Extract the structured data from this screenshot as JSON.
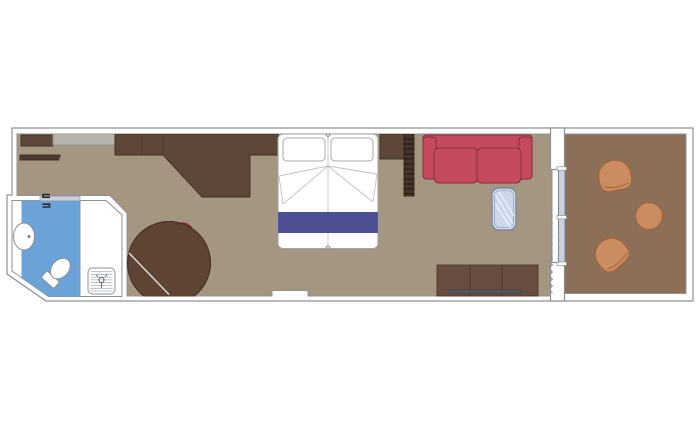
{
  "document": {
    "type": "floor-plan",
    "subject": "cruise-ship-cabin-with-balcony"
  },
  "rooms": [
    {
      "name": "cabin"
    },
    {
      "name": "bathroom"
    },
    {
      "name": "balcony"
    }
  ],
  "furniture": [
    "entry-door",
    "entry-closet",
    "luggage-shelf",
    "wardrobe-desk-unit",
    "washbasin",
    "toilet",
    "shower",
    "shower-drain",
    "bathroom-sliding-door",
    "round-dining-table",
    "red-tub-chair",
    "double-bed",
    "pillows",
    "bed-runner",
    "pullman-ladder",
    "red-sofa",
    "glass-coffee-table",
    "tv-dresser",
    "balcony-sliding-door",
    "curtain",
    "balcony-chair-top",
    "balcony-chair-bottom",
    "balcony-round-table"
  ],
  "colors": {
    "background": "#ffffff",
    "wall_fill": "#ffffff",
    "wall_stroke": "#8f9191",
    "cabin_floor": "#a49681",
    "balcony_floor": "#8b6f57",
    "dark_wood": "#5c4738",
    "dresser_wood": "#684e41",
    "table_wood": "#5e4434",
    "shelf_grey": "#b8b4ac",
    "door_leaf": "#4e3b30",
    "ladder": "#463529",
    "bed_white": "#ffffff",
    "bed_runner": "#4d5094",
    "sofa_red": "#c64a5e",
    "chair_red": "#c62c4d",
    "glass_fill": "#cbd8ea",
    "glass_stroke": "#7d8aa3",
    "bath_blue": "#6ba3d9",
    "slider_fill": "#c8d1dc",
    "slider_stroke": "#6e7a90",
    "balcony_chair": "#ca8c60",
    "balcony_chair_stroke": "#a2663c",
    "curtain": "#8f8f8f",
    "table_line": "#ddd8d0",
    "handle_grey": "#575b5f"
  }
}
